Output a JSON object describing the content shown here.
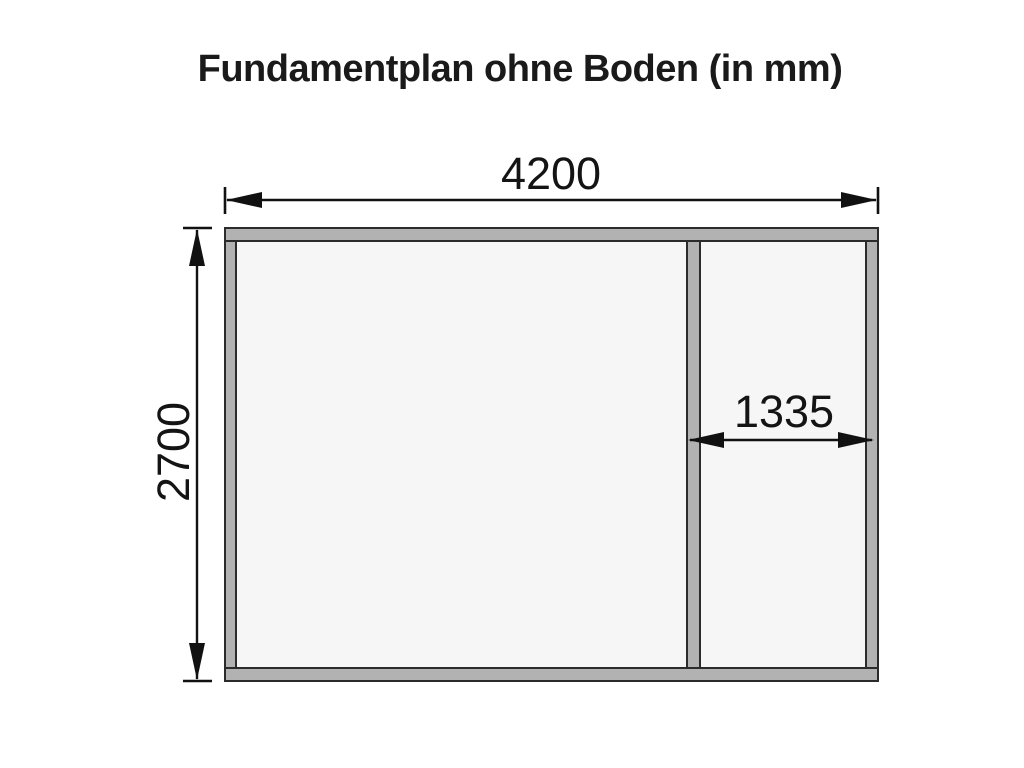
{
  "title": "Fundamentplan ohne Boden (in mm)",
  "diagram": {
    "type": "foundation-plan",
    "unit": "mm",
    "dimensions": {
      "overall_width": "4200",
      "overall_depth": "2700",
      "right_section_width": "1335"
    },
    "colors": {
      "beam_fill": "#b2b2b2",
      "beam_stroke": "#2b2b2b",
      "interior_fill": "#f6f6f6",
      "dim_color": "#111111",
      "text_color": "#1a1a1a",
      "background": "#ffffff"
    }
  }
}
